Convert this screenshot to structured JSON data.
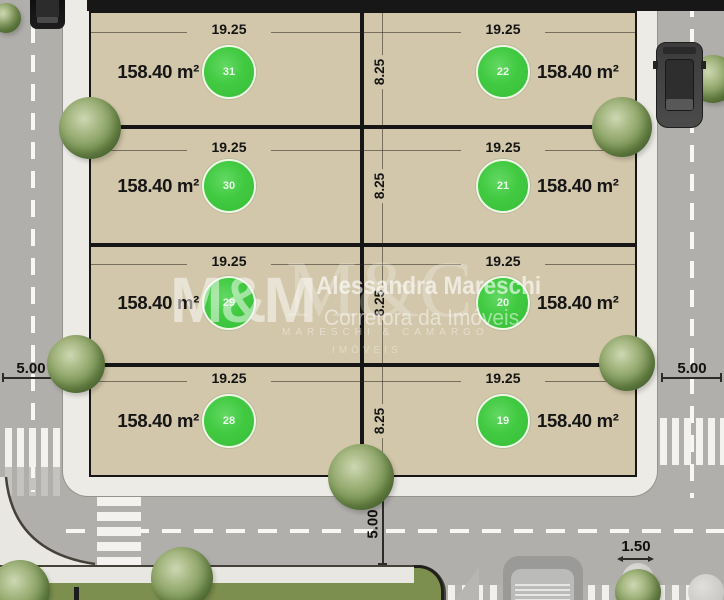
{
  "watermark": {
    "logo_mm": "M&M",
    "monogram": "M&C",
    "name": "Alessandra Mareschi",
    "tagline": "Corretora da Imóveis",
    "firm_line": "MARESCHI & CAMARGO",
    "firm_line2": "IMÓVEIS"
  },
  "dimensions": {
    "left_street_width": "5.00",
    "right_street_width": "5.00",
    "bottom_street_width": "5.00",
    "sidewalk_width": "1.50"
  },
  "lots": {
    "rows": [
      {
        "depth": "8.25",
        "left": {
          "number": "31",
          "width": "19.25",
          "area": "158.40 m²"
        },
        "right": {
          "number": "22",
          "width": "19.25",
          "area": "158.40 m²"
        }
      },
      {
        "depth": "8.25",
        "left": {
          "number": "30",
          "width": "19.25",
          "area": "158.40 m²"
        },
        "right": {
          "number": "21",
          "width": "19.25",
          "area": "158.40 m²"
        }
      },
      {
        "depth": "8.25",
        "left": {
          "number": "29",
          "width": "19.25",
          "area": "158.40 m²"
        },
        "right": {
          "number": "20",
          "width": "19.25",
          "area": "158.40 m²"
        }
      },
      {
        "depth": "8.25",
        "left": {
          "number": "28",
          "width": "19.25",
          "area": "158.40 m²"
        },
        "right": {
          "number": "19",
          "width": "19.25",
          "area": "158.40 m²"
        }
      }
    ]
  },
  "colors": {
    "road": "#b1afab",
    "sidewalk": "#ecebe6",
    "lot_fill": "#d3c7ab",
    "lot_border": "#161616",
    "marker_green": "#41ca41",
    "grass": "#7d8f4e"
  }
}
